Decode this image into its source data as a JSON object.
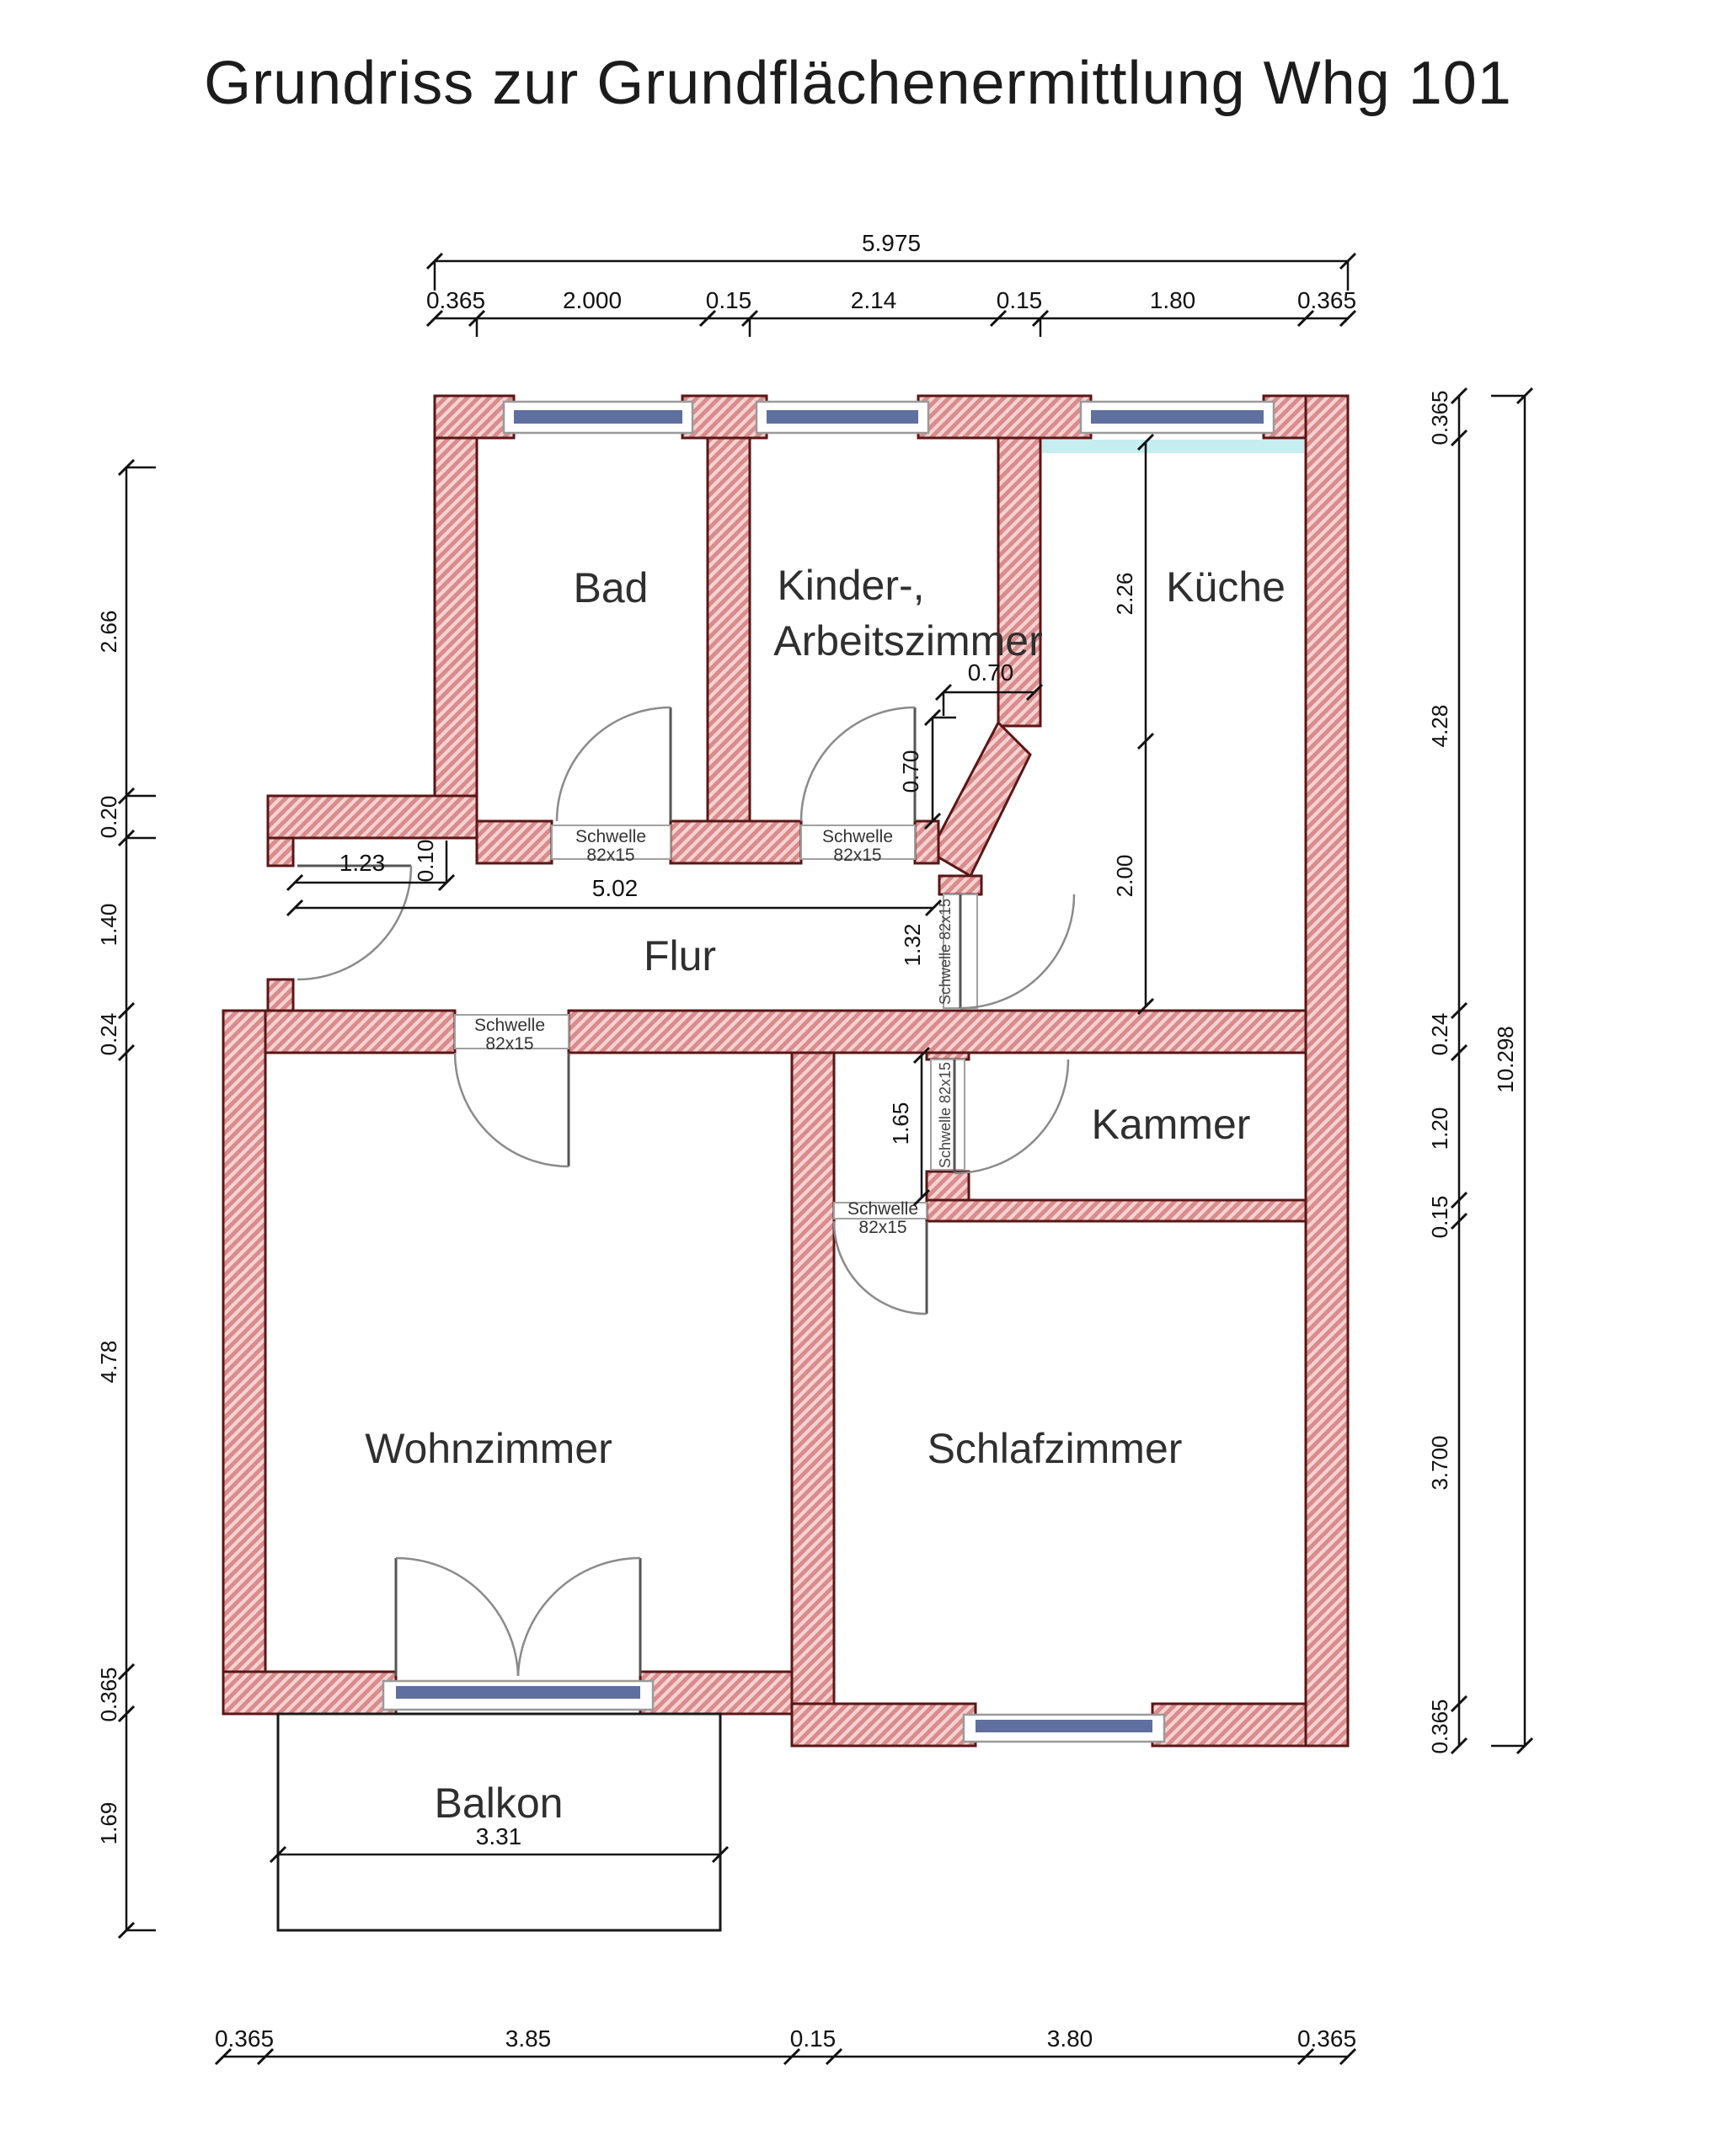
{
  "title": "Grundriss zur Grundflächenermittlung Whg 101",
  "rooms": {
    "bad": "Bad",
    "kinder1": "Kinder-,",
    "kinder2": "Arbeitszimmer",
    "kueche": "Küche",
    "flur": "Flur",
    "kammer": "Kammer",
    "wohnzimmer": "Wohnzimmer",
    "schlafzimmer": "Schlafzimmer",
    "balkon": "Balkon"
  },
  "dims": {
    "top_total": "5.975",
    "top": [
      "0.365",
      "2.000",
      "0.15",
      "2.14",
      "0.15",
      "1.80",
      "0.365"
    ],
    "left": [
      "2.66",
      "0.20",
      "1.40",
      "0.24",
      "4.78",
      "0.365",
      "1.69"
    ],
    "right": [
      "0.365",
      "4.28",
      "0.24",
      "1.20",
      "0.15",
      "3.700",
      "0.365"
    ],
    "right_total": "10.298",
    "bottom": [
      "0.365",
      "3.85",
      "0.15",
      "3.80",
      "0.365"
    ],
    "kueche_upper": "2.26",
    "kueche_lower": "2.00",
    "chamfer_w": "0.70",
    "chamfer_h": "0.70",
    "flur_length": "5.02",
    "entry_width": "1.23",
    "entry_jamb": "0.10",
    "flur_end": "1.32",
    "lobby": "1.65",
    "balkon_width": "3.31"
  },
  "annotations": {
    "schwelle": "Schwelle",
    "schwelle_size": "82x15",
    "schwelle_full": "Schwelle 82x15"
  },
  "colors": {
    "wall_fill": "#f7d2d2",
    "wall_stripe": "#d98c8c",
    "wall_outline": "#5a1616",
    "window_glass": "#5f6f9f",
    "kueche_sill": "#c6eef0"
  }
}
